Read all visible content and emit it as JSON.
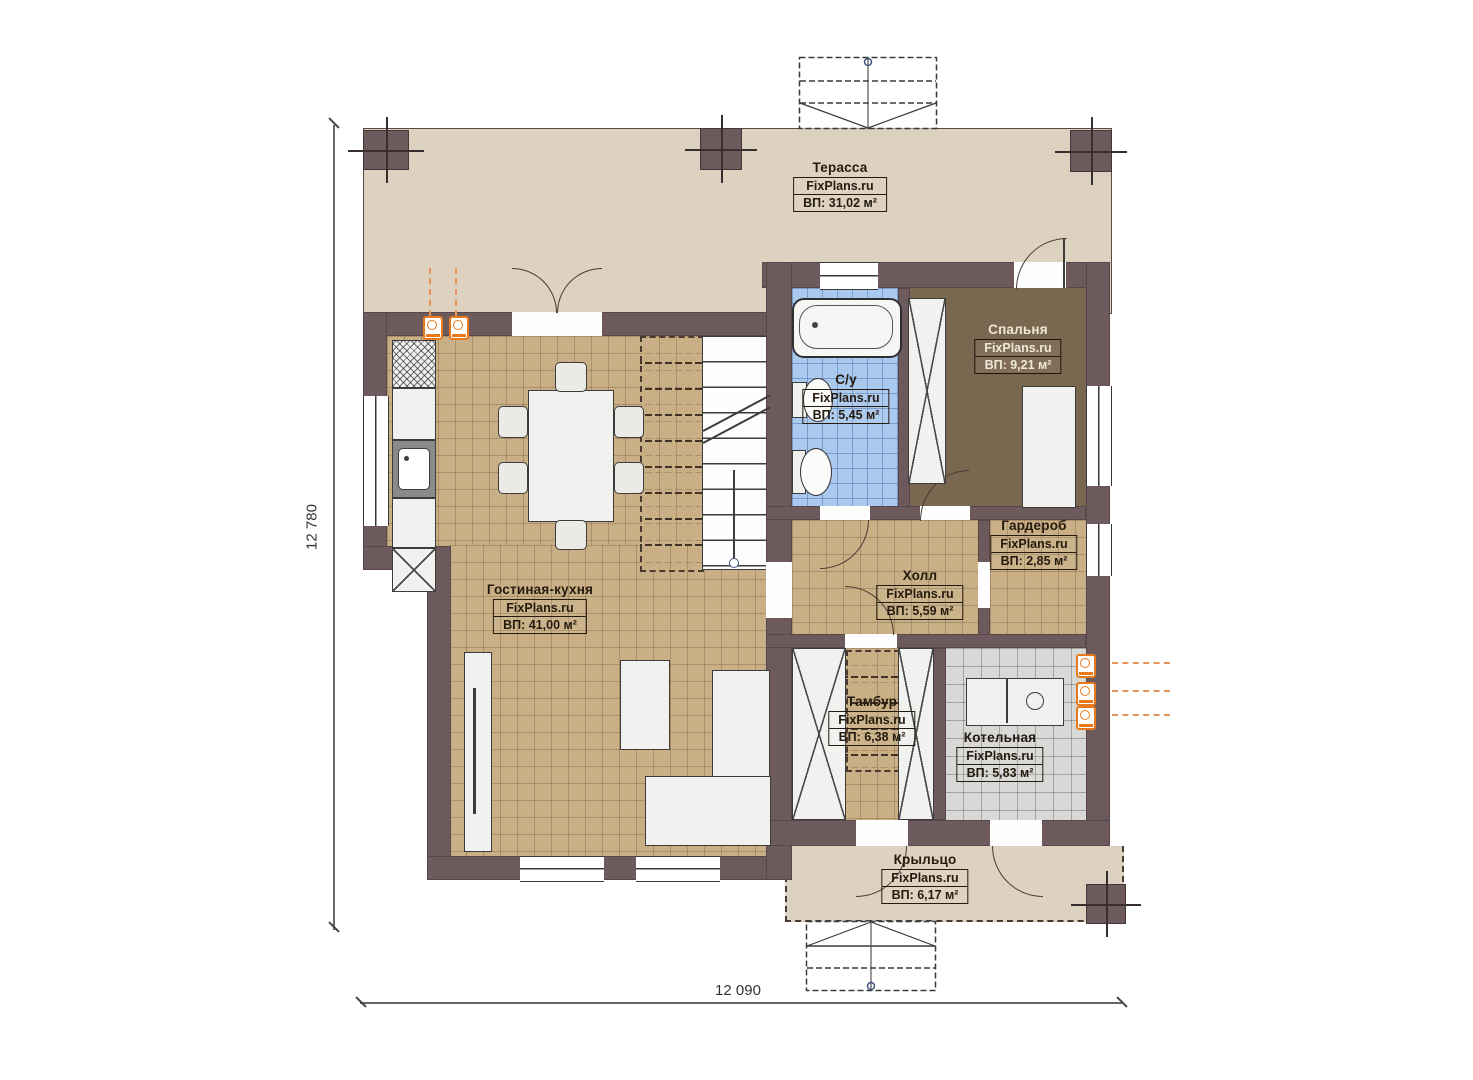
{
  "meta": {
    "brand": "FixPlans.ru"
  },
  "dimensions": {
    "left": "12 780",
    "bottom": "12 090"
  },
  "rooms": [
    {
      "id": "terrace",
      "name": "Терасса",
      "area": "ВП: 31,02 м²"
    },
    {
      "id": "bedroom",
      "name": "Спальня",
      "area": "ВП: 9,21 м²"
    },
    {
      "id": "bathroom",
      "name": "С/у",
      "area": "ВП: 5,45 м²"
    },
    {
      "id": "wardrobe",
      "name": "Гардероб",
      "area": "ВП: 2,85 м²"
    },
    {
      "id": "hall",
      "name": "Холл",
      "area": "ВП: 5,59 м²"
    },
    {
      "id": "living_kitchen",
      "name": "Гостиная-кухня",
      "area": "ВП: 41,00 м²"
    },
    {
      "id": "vestibule",
      "name": "Тамбур",
      "area": "ВП: 6,38 м²"
    },
    {
      "id": "boiler",
      "name": "Котельная",
      "area": "ВП: 5,83 м²"
    },
    {
      "id": "porch",
      "name": "Крыльцо",
      "area": "ВП: 6,17 м²"
    }
  ],
  "colors": {
    "wall": "#6d5a5d",
    "terrace_floor": "#ddd1bf",
    "tile_tan": "#c9af85",
    "tile_blue": "#aac9ee",
    "tile_gray": "#d8d8d6",
    "bedroom_floor": "#7a6750",
    "accent_orange": "#e87a1e",
    "label_ink": "#241a0e"
  }
}
